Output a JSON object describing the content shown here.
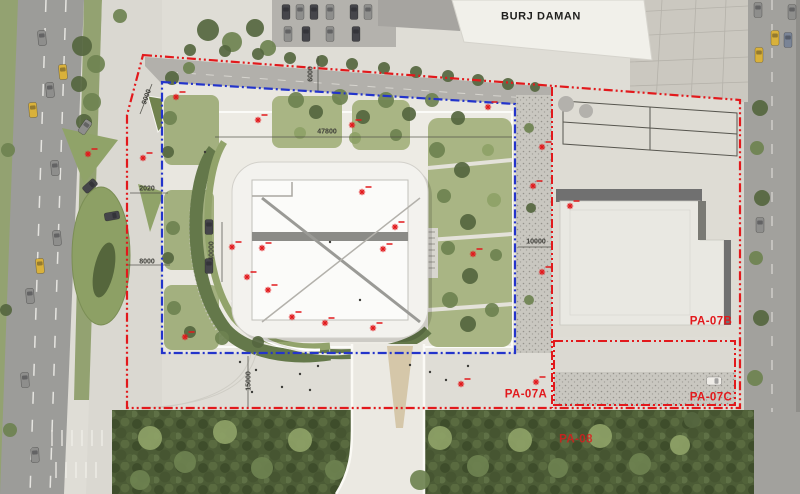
{
  "labels": {
    "burj_daman": "BURJ DAMAN",
    "pa07a": "PA-07A",
    "pa07b": "PA-07B",
    "pa07c": "PA-07C",
    "pa08": "PA-08"
  },
  "dimensions": [
    {
      "text": "9000",
      "x": 147,
      "y": 97,
      "rot": -70
    },
    {
      "text": "6000",
      "x": 311,
      "y": 74,
      "rot": -90
    },
    {
      "text": "47800",
      "x": 327,
      "y": 132,
      "rot": 0
    },
    {
      "text": "2020",
      "x": 147,
      "y": 189,
      "rot": 0
    },
    {
      "text": "8000",
      "x": 147,
      "y": 262,
      "rot": 0
    },
    {
      "text": "40000",
      "x": 212,
      "y": 251,
      "rot": -90
    },
    {
      "text": "10000",
      "x": 536,
      "y": 242,
      "rot": 0
    },
    {
      "text": "15000",
      "x": 249,
      "y": 381,
      "rot": -90
    }
  ],
  "colors": {
    "boundary_red": "#e2191c",
    "boundary_blue": "#2334cb",
    "label_red": "#e2191c",
    "label_dark": "#1f1f1d",
    "tree_shades": [
      "#55663f",
      "#6e8250",
      "#8ea267"
    ],
    "car_colors": {
      "taxi": "#d9b13b",
      "gray": "#8e8e8c",
      "dark": "#45454a",
      "white": "#efede8",
      "blue": "#7a8496"
    }
  },
  "markers": [
    [
      88,
      154
    ],
    [
      143,
      158
    ],
    [
      176,
      97
    ],
    [
      258,
      120
    ],
    [
      352,
      125
    ],
    [
      488,
      107
    ],
    [
      232,
      247
    ],
    [
      247,
      277
    ],
    [
      262,
      248
    ],
    [
      268,
      290
    ],
    [
      292,
      317
    ],
    [
      325,
      323
    ],
    [
      362,
      192
    ],
    [
      383,
      249
    ],
    [
      395,
      227
    ],
    [
      373,
      328
    ],
    [
      185,
      337
    ],
    [
      542,
      147
    ],
    [
      542,
      272
    ],
    [
      473,
      254
    ],
    [
      461,
      384
    ],
    [
      536,
      382
    ],
    [
      533,
      186
    ],
    [
      570,
      206
    ]
  ],
  "trees": [
    [
      82,
      46,
      10,
      0
    ],
    [
      96,
      64,
      9,
      1
    ],
    [
      79,
      84,
      8,
      0
    ],
    [
      92,
      102,
      9,
      1
    ],
    [
      84,
      122,
      8,
      0
    ],
    [
      120,
      16,
      7,
      1
    ],
    [
      172,
      78,
      7,
      0
    ],
    [
      189,
      68,
      6,
      1
    ],
    [
      208,
      30,
      11,
      0
    ],
    [
      232,
      42,
      10,
      1
    ],
    [
      255,
      28,
      9,
      0
    ],
    [
      268,
      48,
      8,
      1
    ],
    [
      190,
      50,
      6,
      0
    ],
    [
      225,
      51,
      6,
      0
    ],
    [
      258,
      54,
      6,
      0
    ],
    [
      290,
      58,
      6,
      0
    ],
    [
      322,
      61,
      6,
      0
    ],
    [
      352,
      64,
      6,
      0
    ],
    [
      384,
      68,
      6,
      0
    ],
    [
      416,
      72,
      6,
      0
    ],
    [
      448,
      76,
      6,
      0
    ],
    [
      478,
      80,
      6,
      0
    ],
    [
      508,
      84,
      6,
      0
    ],
    [
      535,
      87,
      5,
      0
    ],
    [
      296,
      100,
      8,
      1
    ],
    [
      316,
      112,
      7,
      0
    ],
    [
      340,
      97,
      8,
      1
    ],
    [
      363,
      117,
      7,
      0
    ],
    [
      386,
      100,
      8,
      1
    ],
    [
      409,
      114,
      7,
      0
    ],
    [
      300,
      133,
      6,
      2
    ],
    [
      355,
      138,
      6,
      2
    ],
    [
      396,
      135,
      6,
      1
    ],
    [
      432,
      100,
      7,
      1
    ],
    [
      458,
      118,
      7,
      0
    ],
    [
      437,
      150,
      8,
      1
    ],
    [
      462,
      170,
      8,
      0
    ],
    [
      444,
      196,
      7,
      1
    ],
    [
      468,
      222,
      8,
      0
    ],
    [
      448,
      248,
      7,
      1
    ],
    [
      470,
      276,
      8,
      0
    ],
    [
      450,
      300,
      8,
      1
    ],
    [
      468,
      324,
      8,
      0
    ],
    [
      492,
      310,
      7,
      1
    ],
    [
      494,
      200,
      7,
      2
    ],
    [
      496,
      255,
      6,
      1
    ],
    [
      488,
      150,
      6,
      2
    ],
    [
      170,
      118,
      7,
      1
    ],
    [
      168,
      152,
      6,
      0
    ],
    [
      173,
      228,
      7,
      1
    ],
    [
      168,
      258,
      6,
      0
    ],
    [
      174,
      308,
      7,
      1
    ],
    [
      190,
      332,
      6,
      0
    ],
    [
      222,
      338,
      7,
      1
    ],
    [
      258,
      342,
      6,
      0
    ],
    [
      529,
      128,
      5,
      1
    ],
    [
      531,
      208,
      5,
      0
    ],
    [
      529,
      300,
      5,
      1
    ],
    [
      760,
      108,
      8,
      0
    ],
    [
      757,
      148,
      7,
      1
    ],
    [
      762,
      198,
      8,
      0
    ],
    [
      756,
      258,
      7,
      1
    ],
    [
      761,
      318,
      8,
      0
    ],
    [
      755,
      378,
      8,
      1
    ],
    [
      8,
      150,
      7,
      1
    ],
    [
      6,
      310,
      6,
      0
    ],
    [
      10,
      430,
      7,
      1
    ],
    [
      150,
      438,
      12,
      2
    ],
    [
      185,
      462,
      11,
      1
    ],
    [
      225,
      432,
      12,
      2
    ],
    [
      262,
      468,
      11,
      1
    ],
    [
      300,
      440,
      12,
      2
    ],
    [
      335,
      470,
      10,
      1
    ],
    [
      440,
      438,
      12,
      2
    ],
    [
      478,
      466,
      11,
      1
    ],
    [
      520,
      440,
      12,
      2
    ],
    [
      558,
      468,
      10,
      1
    ],
    [
      600,
      436,
      12,
      2
    ],
    [
      640,
      464,
      11,
      1
    ],
    [
      140,
      480,
      10,
      1
    ],
    [
      420,
      480,
      10,
      1
    ],
    [
      680,
      445,
      10,
      2
    ],
    [
      692,
      420,
      8,
      0
    ]
  ],
  "cars": [
    [
      42,
      38,
      -5,
      "gray"
    ],
    [
      63,
      72,
      -5,
      "taxi"
    ],
    [
      50,
      90,
      -5,
      "gray"
    ],
    [
      33,
      110,
      -5,
      "taxi"
    ],
    [
      55,
      168,
      -5,
      "gray"
    ],
    [
      57,
      238,
      -5,
      "gray"
    ],
    [
      40,
      266,
      -5,
      "taxi"
    ],
    [
      30,
      296,
      -5,
      "gray"
    ],
    [
      25,
      380,
      -4,
      "gray"
    ],
    [
      35,
      455,
      -3,
      "gray"
    ],
    [
      85,
      127,
      35,
      "gray"
    ],
    [
      90,
      186,
      48,
      "dark"
    ],
    [
      112,
      216,
      80,
      "dark"
    ],
    [
      209,
      227,
      0,
      "dark"
    ],
    [
      209,
      266,
      0,
      "dark"
    ],
    [
      286,
      12,
      0,
      "dark"
    ],
    [
      300,
      12,
      0,
      "gray"
    ],
    [
      314,
      12,
      0,
      "dark"
    ],
    [
      330,
      12,
      0,
      "gray"
    ],
    [
      354,
      12,
      0,
      "dark"
    ],
    [
      368,
      12,
      0,
      "gray"
    ],
    [
      288,
      34,
      0,
      "gray"
    ],
    [
      306,
      34,
      0,
      "dark"
    ],
    [
      330,
      34,
      0,
      "gray"
    ],
    [
      356,
      34,
      0,
      "dark"
    ],
    [
      758,
      10,
      0,
      "gray"
    ],
    [
      775,
      38,
      0,
      "taxi"
    ],
    [
      759,
      55,
      0,
      "taxi"
    ],
    [
      788,
      40,
      0,
      "blue"
    ],
    [
      792,
      12,
      0,
      "gray"
    ],
    [
      760,
      225,
      0,
      "gray"
    ],
    [
      714,
      381,
      90,
      "white"
    ]
  ]
}
